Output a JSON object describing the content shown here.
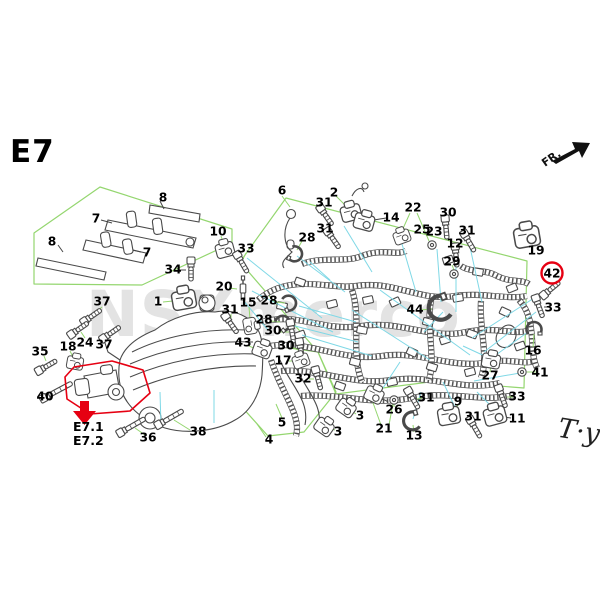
{
  "meta": {
    "title": "E7",
    "fr_label": "FR.",
    "signature": "T·y"
  },
  "watermark": {
    "text": "NSXmerco"
  },
  "highlight": {
    "circled_part": "42",
    "ref1": "E7.1",
    "ref2": "E7.2",
    "color": "#e60012"
  },
  "colors": {
    "region_green": "#94d66f",
    "leader_cyan": "#7fd8e6",
    "leader_dark": "#444444",
    "line_art": "#4a4a4a",
    "watermark_gray": "#e3e3e3",
    "label_black": "#000000"
  },
  "parts": [
    {
      "n": "7",
      "x": 96,
      "y": 219
    },
    {
      "n": "8",
      "x": 163,
      "y": 198
    },
    {
      "n": "8",
      "x": 52,
      "y": 242
    },
    {
      "n": "7",
      "x": 147,
      "y": 253
    },
    {
      "n": "34",
      "x": 173,
      "y": 270,
      "glyph": "bolt",
      "gx": 191,
      "gy": 270,
      "rot": 90
    },
    {
      "n": "1",
      "x": 158,
      "y": 302,
      "glyph": "comp",
      "gx": 184,
      "gy": 300,
      "rot": -10,
      "scale": 1.3
    },
    {
      "n": "37",
      "x": 102,
      "y": 302,
      "glyph": "bolt",
      "gx": 92,
      "gy": 316,
      "rot": -35
    },
    {
      "n": "24",
      "x": 85,
      "y": 343,
      "glyph": "bolt",
      "gx": 79,
      "gy": 329,
      "rot": -35
    },
    {
      "n": "37",
      "x": 104,
      "y": 345,
      "glyph": "bolt",
      "gx": 111,
      "gy": 333,
      "rot": -35
    },
    {
      "n": "35",
      "x": 40,
      "y": 352,
      "glyph": "bolt",
      "gx": 47,
      "gy": 366,
      "rot": -30
    },
    {
      "n": "18",
      "x": 68,
      "y": 347,
      "glyph": "comp",
      "gx": 75,
      "gy": 363,
      "rot": 10,
      "scale": 0.9
    },
    {
      "n": "40",
      "x": 45,
      "y": 397,
      "glyph": "bolt",
      "gx": 57,
      "gy": 391,
      "rot": -28,
      "len": 26
    },
    {
      "n": "36",
      "x": 148,
      "y": 438,
      "glyph": "bolt",
      "gx": 132,
      "gy": 426,
      "rot": -30,
      "len": 22
    },
    {
      "n": "38",
      "x": 198,
      "y": 432,
      "glyph": "bolt",
      "gx": 170,
      "gy": 418,
      "rot": -30,
      "len": 22
    },
    {
      "n": "6",
      "x": 282,
      "y": 191
    },
    {
      "n": "10",
      "x": 218,
      "y": 232,
      "glyph": "comp",
      "gx": 225,
      "gy": 250,
      "rot": -15
    },
    {
      "n": "33",
      "x": 246,
      "y": 249,
      "glyph": "bolt",
      "gx": 242,
      "gy": 263,
      "rot": 60
    },
    {
      "n": "20",
      "x": 224,
      "y": 287,
      "glyph": "plug",
      "gx": 243,
      "gy": 288
    },
    {
      "n": "31",
      "x": 230,
      "y": 310,
      "glyph": "bolt",
      "gx": 231,
      "gy": 324,
      "rot": 55
    },
    {
      "n": "15",
      "x": 248,
      "y": 303,
      "glyph": "comp",
      "gx": 250,
      "gy": 326,
      "rot": 80,
      "scale": 0.9
    },
    {
      "n": "28",
      "x": 307,
      "y": 238,
      "glyph": "clip",
      "gx": 295,
      "gy": 254,
      "rot": 200
    },
    {
      "n": "28",
      "x": 269,
      "y": 301,
      "glyph": "clip",
      "gx": 289,
      "gy": 303,
      "rot": 160
    },
    {
      "n": "28",
      "x": 264,
      "y": 320,
      "glyph": "clip",
      "gx": 283,
      "gy": 323,
      "rot": 140
    },
    {
      "n": "30",
      "x": 273,
      "y": 331,
      "glyph": "bolt",
      "gx": 292,
      "gy": 332,
      "rot": 80
    },
    {
      "n": "43",
      "x": 243,
      "y": 343,
      "glyph": "comp",
      "gx": 262,
      "gy": 350,
      "rot": 20
    },
    {
      "n": "30",
      "x": 286,
      "y": 346,
      "glyph": "bolt",
      "gx": 301,
      "gy": 351,
      "rot": 80
    },
    {
      "n": "17",
      "x": 283,
      "y": 361,
      "glyph": "comp",
      "gx": 301,
      "gy": 361,
      "rot": -20,
      "scale": 0.9
    },
    {
      "n": "32",
      "x": 303,
      "y": 379,
      "glyph": "bolt",
      "gx": 318,
      "gy": 379,
      "rot": 75
    },
    {
      "n": "5",
      "x": 282,
      "y": 423
    },
    {
      "n": "4",
      "x": 269,
      "y": 440
    },
    {
      "n": "3",
      "x": 360,
      "y": 416,
      "glyph": "comp",
      "gx": 346,
      "gy": 408,
      "rot": 35
    },
    {
      "n": "3",
      "x": 338,
      "y": 432,
      "glyph": "comp",
      "gx": 324,
      "gy": 427,
      "rot": 35
    },
    {
      "n": "21",
      "x": 384,
      "y": 429,
      "glyph": "comp",
      "gx": 374,
      "gy": 395,
      "rot": 25
    },
    {
      "n": "26",
      "x": 394,
      "y": 410,
      "glyph": "ring",
      "gx": 394,
      "gy": 400
    },
    {
      "n": "13",
      "x": 414,
      "y": 436,
      "glyph": "clip",
      "gx": 412,
      "gy": 421,
      "rot": -15,
      "scale": 1.2
    },
    {
      "n": "31",
      "x": 426,
      "y": 398,
      "glyph": "bolt",
      "gx": 413,
      "gy": 399,
      "rot": 60
    },
    {
      "n": "9",
      "x": 458,
      "y": 402,
      "glyph": "comp",
      "gx": 449,
      "gy": 416,
      "rot": -10,
      "scale": 1.2
    },
    {
      "n": "31",
      "x": 473,
      "y": 417,
      "glyph": "bolt",
      "gx": 475,
      "gy": 428,
      "rot": 60
    },
    {
      "n": "33",
      "x": 517,
      "y": 397,
      "glyph": "bolt",
      "gx": 502,
      "gy": 397,
      "rot": 70
    },
    {
      "n": "11",
      "x": 517,
      "y": 419,
      "glyph": "comp",
      "gx": 495,
      "gy": 416,
      "rot": -15,
      "scale": 1.2
    },
    {
      "n": "2",
      "x": 334,
      "y": 193,
      "glyph": "comp",
      "gx": 351,
      "gy": 213,
      "rot": -15,
      "scale": 1.1
    },
    {
      "n": "31",
      "x": 324,
      "y": 203,
      "glyph": "bolt",
      "gx": 326,
      "gy": 216,
      "rot": 55
    },
    {
      "n": "31",
      "x": 325,
      "y": 229,
      "glyph": "bolt",
      "gx": 333,
      "gy": 239,
      "rot": 55
    },
    {
      "n": "14",
      "x": 391,
      "y": 218,
      "glyph": "comp",
      "gx": 364,
      "gy": 222,
      "rot": 15,
      "scale": 1.1
    },
    {
      "n": "22",
      "x": 413,
      "y": 208
    },
    {
      "n": "25",
      "x": 422,
      "y": 230,
      "glyph": "comp",
      "gx": 402,
      "gy": 237,
      "rot": -20,
      "scale": 0.9
    },
    {
      "n": "23",
      "x": 434,
      "y": 232,
      "glyph": "ring",
      "gx": 432,
      "gy": 245
    },
    {
      "n": "30",
      "x": 448,
      "y": 213,
      "glyph": "bolt",
      "gx": 446,
      "gy": 228,
      "rot": 85
    },
    {
      "n": "31",
      "x": 467,
      "y": 231,
      "glyph": "bolt",
      "gx": 469,
      "gy": 242,
      "rot": 60
    },
    {
      "n": "12",
      "x": 455,
      "y": 244,
      "glyph": "bolt",
      "gx": 456,
      "gy": 256,
      "rot": 85
    },
    {
      "n": "29",
      "x": 452,
      "y": 262,
      "glyph": "ring",
      "gx": 454,
      "gy": 274
    },
    {
      "n": "19",
      "x": 536,
      "y": 251,
      "glyph": "comp",
      "gx": 527,
      "gy": 237,
      "rot": -10,
      "scale": 1.4
    },
    {
      "n": "42",
      "x": 552,
      "y": 274,
      "circled": true,
      "glyph": "bolt",
      "gx": 551,
      "gy": 289,
      "rot": -40
    },
    {
      "n": "33",
      "x": 553,
      "y": 308,
      "glyph": "bolt",
      "gx": 539,
      "gy": 307,
      "rot": 70
    },
    {
      "n": "16",
      "x": 533,
      "y": 351,
      "glyph": "clip",
      "gx": 534,
      "gy": 329,
      "rot": 90
    },
    {
      "n": "41",
      "x": 540,
      "y": 373,
      "glyph": "ring",
      "gx": 522,
      "gy": 372
    },
    {
      "n": "27",
      "x": 490,
      "y": 376,
      "glyph": "comp",
      "gx": 491,
      "gy": 361,
      "rot": 10
    },
    {
      "n": "44",
      "x": 415,
      "y": 310,
      "glyph": "clip",
      "gx": 440,
      "gy": 308,
      "rot": -20,
      "scale": 1.6
    }
  ],
  "regions": [
    {
      "name": "fuel-rail-group",
      "points": "34,233 100,187 232,229 232,243 142,285 34,284"
    },
    {
      "name": "main-harness-group",
      "points": "286,198 527,261 524,388 437,381 336,394 318,352 240,262"
    },
    {
      "name": "sub-harness-group",
      "points": "232,340 318,352 336,392 304,432 268,436 232,396"
    }
  ],
  "leaders": {
    "green": [
      [
        282,
        196,
        290,
        207
      ],
      [
        221,
        236,
        224,
        245
      ],
      [
        246,
        253,
        243,
        259
      ],
      [
        229,
        288,
        237,
        289
      ],
      [
        231,
        314,
        231,
        320
      ],
      [
        249,
        307,
        250,
        319
      ],
      [
        302,
        241,
        297,
        250
      ],
      [
        276,
        302,
        285,
        303
      ],
      [
        271,
        321,
        280,
        322
      ],
      [
        279,
        332,
        289,
        332
      ],
      [
        249,
        346,
        256,
        349
      ],
      [
        292,
        347,
        298,
        350
      ],
      [
        289,
        361,
        296,
        361
      ],
      [
        309,
        379,
        314,
        379
      ],
      [
        282,
        418,
        276,
        404
      ],
      [
        266,
        437,
        257,
        424
      ],
      [
        356,
        414,
        350,
        410
      ],
      [
        335,
        430,
        328,
        427
      ],
      [
        381,
        425,
        372,
        400
      ],
      [
        389,
        425,
        393,
        403
      ],
      [
        394,
        407,
        394,
        403
      ],
      [
        414,
        432,
        413,
        425
      ],
      [
        422,
        398,
        417,
        399
      ],
      [
        458,
        405,
        452,
        412
      ],
      [
        471,
        419,
        474,
        424
      ],
      [
        513,
        397,
        507,
        397
      ],
      [
        336,
        196,
        347,
        207
      ],
      [
        325,
        207,
        326,
        213
      ],
      [
        327,
        232,
        331,
        237
      ],
      [
        410,
        213,
        401,
        233
      ],
      [
        417,
        213,
        429,
        241
      ],
      [
        448,
        217,
        447,
        224
      ],
      [
        465,
        234,
        468,
        239
      ],
      [
        455,
        247,
        456,
        252
      ],
      [
        452,
        265,
        454,
        270
      ],
      [
        533,
        248,
        528,
        241
      ],
      [
        533,
        347,
        534,
        334
      ],
      [
        536,
        372,
        527,
        372
      ],
      [
        490,
        372,
        491,
        365
      ],
      [
        420,
        310,
        432,
        309
      ],
      [
        145,
        435,
        135,
        428
      ],
      [
        190,
        430,
        174,
        420
      ],
      [
        102,
        307,
        96,
        312
      ],
      [
        85,
        338,
        81,
        332
      ],
      [
        105,
        341,
        109,
        337
      ],
      [
        44,
        356,
        46,
        361
      ],
      [
        70,
        351,
        73,
        357
      ],
      [
        49,
        393,
        53,
        391
      ],
      [
        163,
        302,
        173,
        301
      ]
    ],
    "cyan": [
      [
        247,
        258,
        322,
        318
      ],
      [
        252,
        291,
        333,
        332
      ],
      [
        297,
        256,
        345,
        292
      ],
      [
        299,
        306,
        356,
        322
      ],
      [
        287,
        324,
        358,
        342
      ],
      [
        302,
        335,
        372,
        356
      ],
      [
        344,
        226,
        372,
        272
      ],
      [
        402,
        244,
        416,
        292
      ],
      [
        437,
        249,
        441,
        302
      ],
      [
        456,
        266,
        456,
        312
      ],
      [
        470,
        247,
        482,
        302
      ],
      [
        545,
        291,
        472,
        338
      ],
      [
        536,
        312,
        484,
        352
      ],
      [
        528,
        332,
        486,
        362
      ],
      [
        520,
        373,
        474,
        381
      ],
      [
        489,
        358,
        463,
        346
      ],
      [
        443,
        312,
        424,
        332
      ],
      [
        455,
        407,
        443,
        382
      ],
      [
        413,
        419,
        421,
        392
      ],
      [
        377,
        397,
        400,
        362
      ],
      [
        496,
        411,
        477,
        392
      ],
      [
        214,
        390,
        214,
        423
      ],
      [
        160,
        392,
        161,
        426
      ],
      [
        243,
        300,
        268,
        330
      ],
      [
        310,
        262,
        330,
        280
      ],
      [
        352,
        310,
        430,
        360
      ],
      [
        380,
        290,
        470,
        355
      ]
    ],
    "dark": [
      [
        101,
        220,
        112,
        223
      ],
      [
        160,
        201,
        164,
        209
      ],
      [
        58,
        245,
        63,
        252
      ],
      [
        141,
        252,
        133,
        250
      ],
      [
        179,
        270,
        186,
        270
      ],
      [
        544,
        307,
        547,
        307
      ],
      [
        511,
        418,
        504,
        417
      ],
      [
        386,
        218,
        374,
        220
      ]
    ]
  }
}
